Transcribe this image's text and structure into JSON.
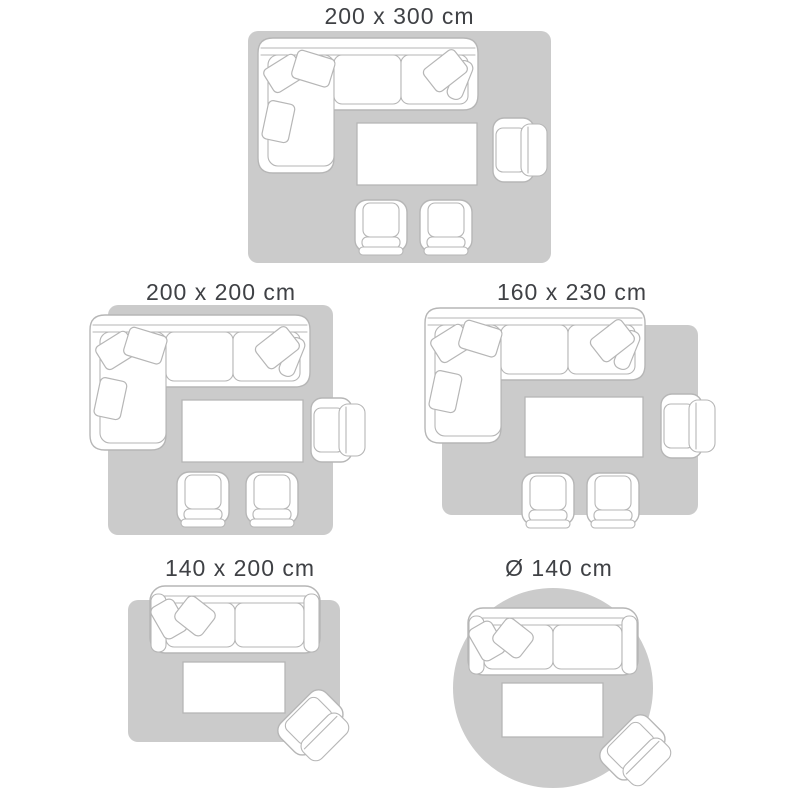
{
  "diagram": {
    "type": "rug-size-guide",
    "background": "#ffffff",
    "rug_fill": "#cbcbcb",
    "furniture_outline": "#b6b6b6",
    "furniture_fill": "#ffffff",
    "label_color": "#3f4145"
  },
  "panels": [
    {
      "label": "200 x 300 cm",
      "rug_shape": "rectangle",
      "furniture": [
        "sectional-sofa",
        "coffee-table",
        "armchair",
        "lounge-chair",
        "lounge-chair"
      ]
    },
    {
      "label": "200 x 200 cm",
      "rug_shape": "rectangle",
      "furniture": [
        "sectional-sofa",
        "coffee-table",
        "armchair",
        "lounge-chair",
        "lounge-chair"
      ]
    },
    {
      "label": "160 x 230 cm",
      "rug_shape": "rectangle",
      "furniture": [
        "sectional-sofa",
        "coffee-table",
        "armchair",
        "lounge-chair",
        "lounge-chair"
      ]
    },
    {
      "label": "140 x 200 cm",
      "rug_shape": "rectangle",
      "furniture": [
        "loveseat-sofa",
        "coffee-table",
        "armchair"
      ]
    },
    {
      "label": "Ø 140 cm",
      "rug_shape": "circle",
      "furniture": [
        "loveseat-sofa",
        "coffee-table",
        "armchair"
      ]
    }
  ]
}
